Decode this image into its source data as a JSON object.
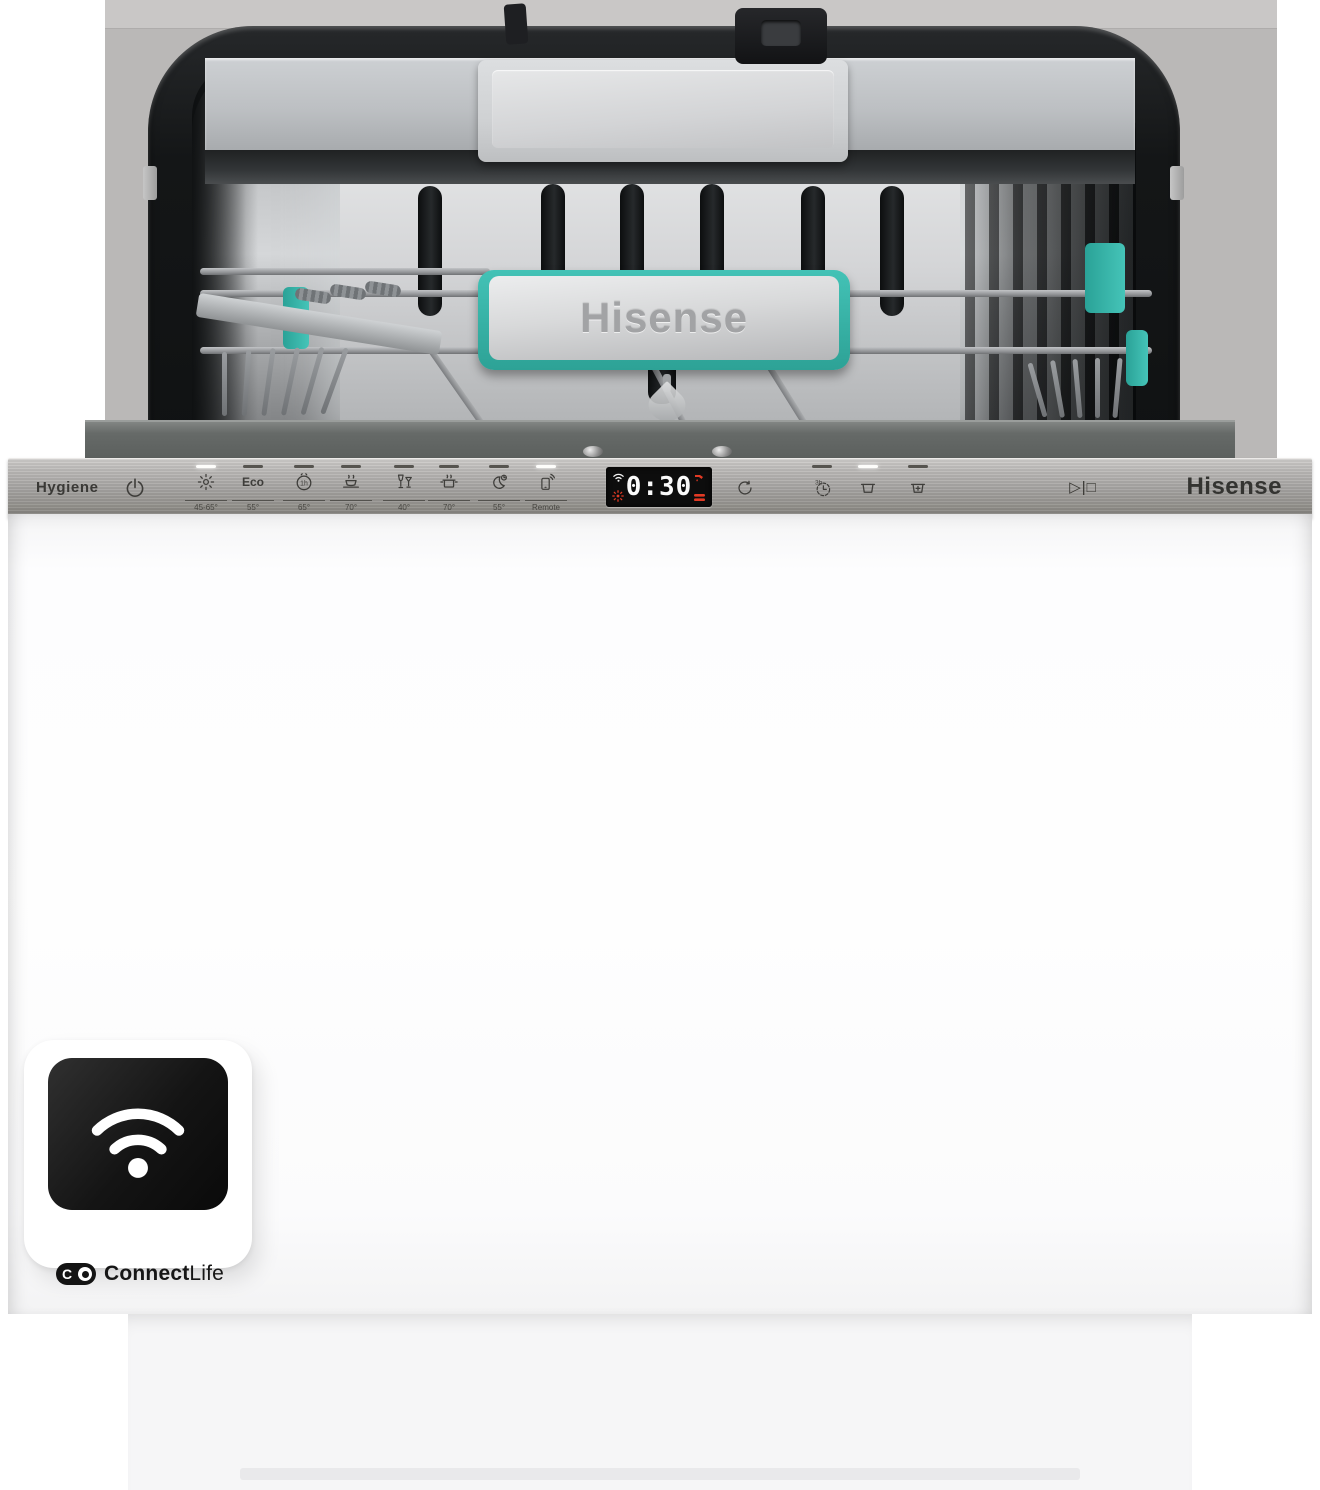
{
  "product": {
    "brand": "Hisense"
  },
  "panel": {
    "hygiene_label": "Hygiene",
    "brand_logo": "Hisense",
    "programs": [
      {
        "icon": "auto-wash",
        "temp": "45-65°",
        "active": true
      },
      {
        "icon": "eco",
        "label": "Eco",
        "temp": "55°",
        "active": false
      },
      {
        "icon": "quick-1h",
        "glyph": "1h",
        "temp": "65°",
        "active": false
      },
      {
        "icon": "intensive-plate",
        "temp": "70°",
        "active": false
      },
      {
        "icon": "glassware",
        "temp": "40°",
        "active": false
      },
      {
        "icon": "pots-pans",
        "temp": "70°",
        "active": false
      },
      {
        "icon": "night-wash",
        "temp": "55°",
        "active": false
      },
      {
        "icon": "remote",
        "label": "Remote",
        "active": true
      }
    ],
    "display": {
      "time": "0:30",
      "status_icons": [
        "wifi",
        "rinse-aid",
        "water-tap",
        "salt"
      ]
    },
    "options": [
      {
        "icon": "delay-start",
        "active": false,
        "has_indicator": false
      },
      {
        "icon": "delay-3h",
        "glyph": "3h",
        "active": false,
        "has_indicator": true
      },
      {
        "icon": "lower-basket",
        "active": true,
        "has_indicator": true
      },
      {
        "icon": "upper-basket-plus",
        "active": false,
        "has_indicator": true
      }
    ],
    "start_label": "▷|□"
  },
  "interior": {
    "handle_logo": "Hisense"
  },
  "badge": {
    "wifi_icon": "wifi",
    "monogram": "C",
    "logo_prefix": "Connect",
    "logo_suffix": "Life"
  }
}
